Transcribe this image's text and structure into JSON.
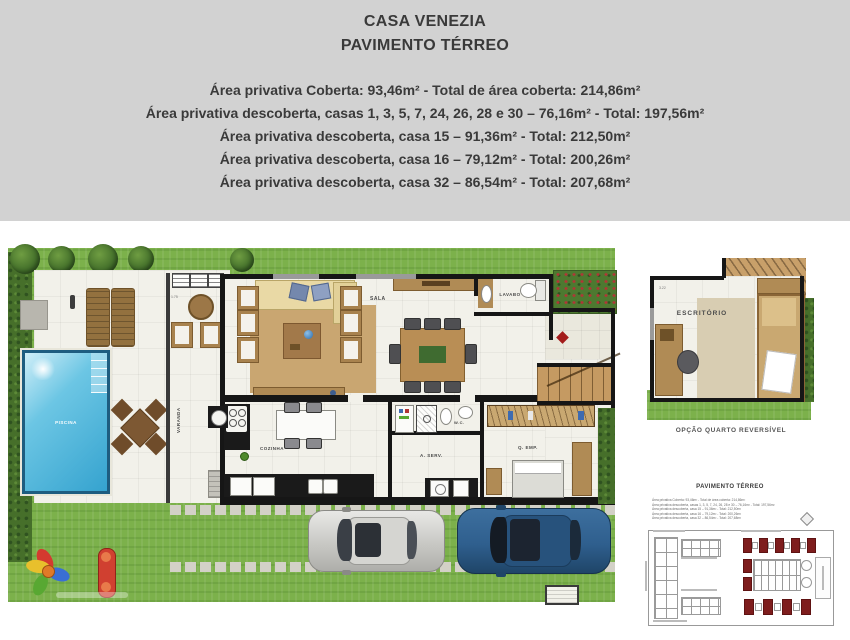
{
  "header": {
    "title_line1": "CASA VENEZIA",
    "title_line2": "PAVIMENTO TÉRREO",
    "area_lines": [
      "Área privativa Coberta: 93,46m² - Total de área coberta: 214,86m²",
      "Área privativa descoberta, casas 1, 3, 5, 7, 24, 26, 28 e 30 – 76,16m² - Total: 197,56m²",
      "Área privativa descoberta, casa 15 – 91,36m² - Total: 212,50m²",
      "Área privativa descoberta, casa 16 – 79,12m² - Total: 200,26m²",
      "Área privativa descoberta, casa 32 – 86,54m² - Total: 207,68m²"
    ]
  },
  "floor_plan": {
    "rooms": {
      "sala": "SALA",
      "lavabo": "LAVABO",
      "cozinha": "COZINHA",
      "varanda": "VARANDA",
      "wc": "W.C.",
      "a_serv": "A. SERV.",
      "q_emp": "Q. EMP.",
      "piscina": "PISCINA"
    },
    "dimensions": {
      "varanda": "1.75",
      "escritorio": "3.22"
    }
  },
  "inset": {
    "room": "ESCRITÓRIO",
    "caption": "OPÇÃO QUARTO REVERSÍVEL"
  },
  "site_plan": {
    "title": "PAVIMENTO TÉRREO"
  },
  "colors": {
    "header_bg": "#d2d2d2",
    "grass": "#7cb14b",
    "pool_water": "#45b4dd",
    "wall": "#161616",
    "wood": "#b08b55",
    "unit_red": "#7e1d1d",
    "car_blue": "#2f5f8e",
    "car_silver": "#d8d8d6",
    "accent_red": "#a31b1b"
  }
}
